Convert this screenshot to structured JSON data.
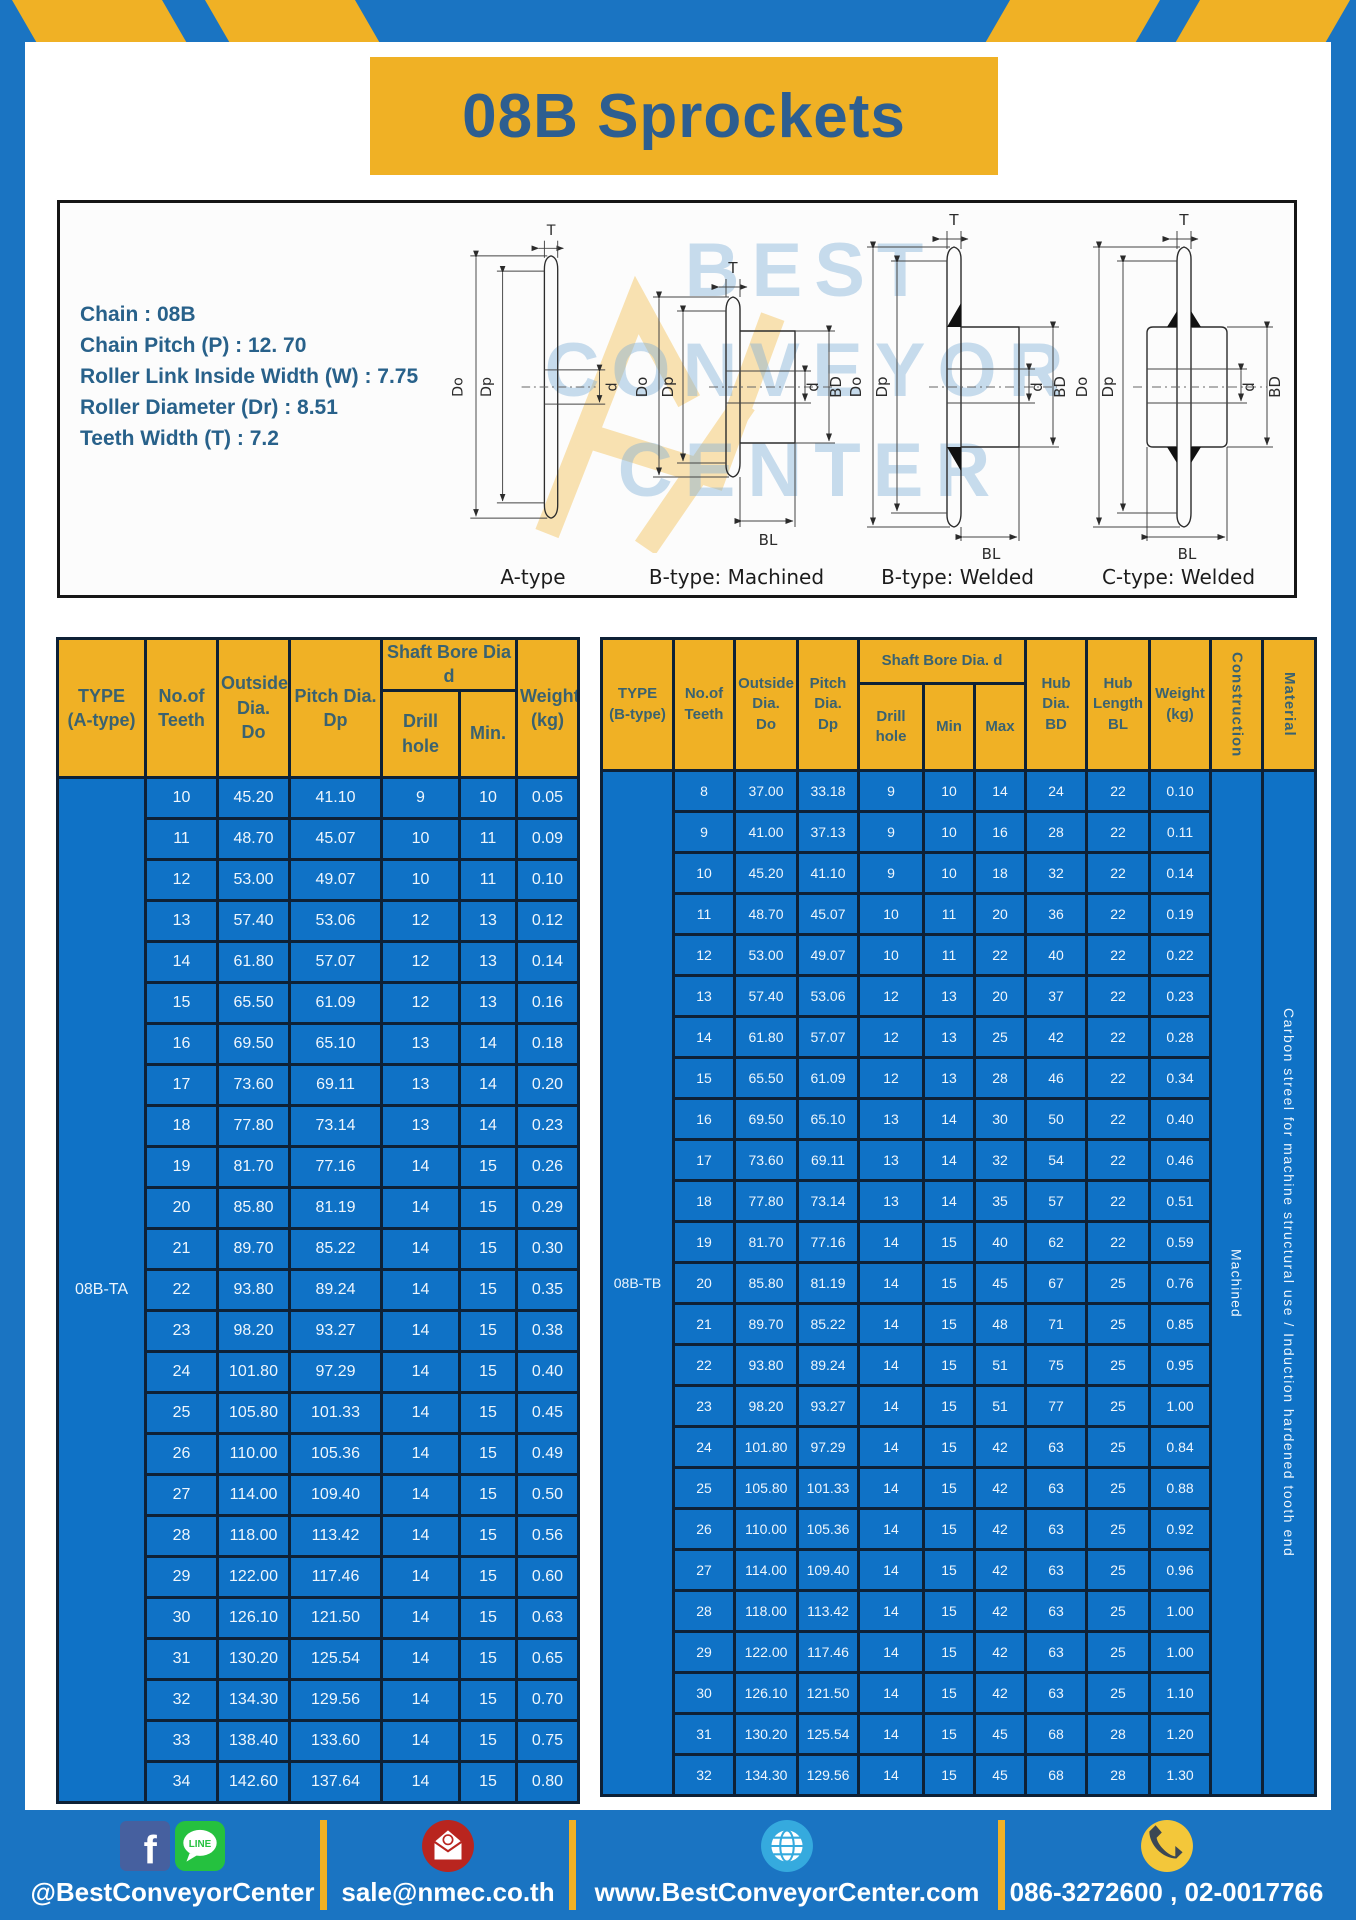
{
  "title": "08B Sprockets",
  "specs": [
    "Chain : 08B",
    "Chain Pitch (P) : 12. 70",
    "Roller Link Inside Width (W) : 7.75",
    "Roller Diameter (Dr) : 8.51",
    "Teeth Width (T) : 7.2"
  ],
  "diagram": {
    "watermark": "BEST\nCONVEYOR\nCENTER",
    "types": [
      "A-type",
      "B-type: Machined",
      "B-type: Welded",
      "C-type: Welded"
    ],
    "dims": {
      "T": "T",
      "Do": "Do",
      "Dp": "Dp",
      "d": "d",
      "BD": "BD",
      "BL": "BL"
    }
  },
  "table_a": {
    "headers": {
      "type": "TYPE\n(A-type)",
      "teeth": "No.of\nTeeth",
      "outside": "Outside\nDia.\nDo",
      "pitch": "Pitch Dia.\nDp",
      "shaft": "Shaft Bore Dia d",
      "drill": "Drill hole",
      "min": "Min.",
      "weight": "Weight\n(kg)"
    },
    "type_label": "08B-TA",
    "rows": [
      [
        "10",
        "45.20",
        "41.10",
        "9",
        "10",
        "0.05"
      ],
      [
        "11",
        "48.70",
        "45.07",
        "10",
        "11",
        "0.09"
      ],
      [
        "12",
        "53.00",
        "49.07",
        "10",
        "11",
        "0.10"
      ],
      [
        "13",
        "57.40",
        "53.06",
        "12",
        "13",
        "0.12"
      ],
      [
        "14",
        "61.80",
        "57.07",
        "12",
        "13",
        "0.14"
      ],
      [
        "15",
        "65.50",
        "61.09",
        "12",
        "13",
        "0.16"
      ],
      [
        "16",
        "69.50",
        "65.10",
        "13",
        "14",
        "0.18"
      ],
      [
        "17",
        "73.60",
        "69.11",
        "13",
        "14",
        "0.20"
      ],
      [
        "18",
        "77.80",
        "73.14",
        "13",
        "14",
        "0.23"
      ],
      [
        "19",
        "81.70",
        "77.16",
        "14",
        "15",
        "0.26"
      ],
      [
        "20",
        "85.80",
        "81.19",
        "14",
        "15",
        "0.29"
      ],
      [
        "21",
        "89.70",
        "85.22",
        "14",
        "15",
        "0.30"
      ],
      [
        "22",
        "93.80",
        "89.24",
        "14",
        "15",
        "0.35"
      ],
      [
        "23",
        "98.20",
        "93.27",
        "14",
        "15",
        "0.38"
      ],
      [
        "24",
        "101.80",
        "97.29",
        "14",
        "15",
        "0.40"
      ],
      [
        "25",
        "105.80",
        "101.33",
        "14",
        "15",
        "0.45"
      ],
      [
        "26",
        "110.00",
        "105.36",
        "14",
        "15",
        "0.49"
      ],
      [
        "27",
        "114.00",
        "109.40",
        "14",
        "15",
        "0.50"
      ],
      [
        "28",
        "118.00",
        "113.42",
        "14",
        "15",
        "0.56"
      ],
      [
        "29",
        "122.00",
        "117.46",
        "14",
        "15",
        "0.60"
      ],
      [
        "30",
        "126.10",
        "121.50",
        "14",
        "15",
        "0.63"
      ],
      [
        "31",
        "130.20",
        "125.54",
        "14",
        "15",
        "0.65"
      ],
      [
        "32",
        "134.30",
        "129.56",
        "14",
        "15",
        "0.70"
      ],
      [
        "33",
        "138.40",
        "133.60",
        "14",
        "15",
        "0.75"
      ],
      [
        "34",
        "142.60",
        "137.64",
        "14",
        "15",
        "0.80"
      ]
    ]
  },
  "table_b": {
    "headers": {
      "type": "TYPE\n(B-type)",
      "teeth": "No.of\nTeeth",
      "outside": "Outside\nDia.\nDo",
      "pitch": "Pitch\nDia.\nDp",
      "shaft": "Shaft Bore Dia. d",
      "drill": "Drill hole",
      "min": "Min",
      "max": "Max",
      "hub_dia": "Hub\nDia.\nBD",
      "hub_len": "Hub\nLength\nBL",
      "weight": "Weight\n(kg)",
      "construction": "Construction",
      "material": "Material"
    },
    "type_label": "08B-TB",
    "construction": "Machined",
    "material": "Carbon streel for machine structural use / Induction hardened tooth end",
    "rows": [
      [
        "8",
        "37.00",
        "33.18",
        "9",
        "10",
        "14",
        "24",
        "22",
        "0.10"
      ],
      [
        "9",
        "41.00",
        "37.13",
        "9",
        "10",
        "16",
        "28",
        "22",
        "0.11"
      ],
      [
        "10",
        "45.20",
        "41.10",
        "9",
        "10",
        "18",
        "32",
        "22",
        "0.14"
      ],
      [
        "11",
        "48.70",
        "45.07",
        "10",
        "11",
        "20",
        "36",
        "22",
        "0.19"
      ],
      [
        "12",
        "53.00",
        "49.07",
        "10",
        "11",
        "22",
        "40",
        "22",
        "0.22"
      ],
      [
        "13",
        "57.40",
        "53.06",
        "12",
        "13",
        "20",
        "37",
        "22",
        "0.23"
      ],
      [
        "14",
        "61.80",
        "57.07",
        "12",
        "13",
        "25",
        "42",
        "22",
        "0.28"
      ],
      [
        "15",
        "65.50",
        "61.09",
        "12",
        "13",
        "28",
        "46",
        "22",
        "0.34"
      ],
      [
        "16",
        "69.50",
        "65.10",
        "13",
        "14",
        "30",
        "50",
        "22",
        "0.40"
      ],
      [
        "17",
        "73.60",
        "69.11",
        "13",
        "14",
        "32",
        "54",
        "22",
        "0.46"
      ],
      [
        "18",
        "77.80",
        "73.14",
        "13",
        "14",
        "35",
        "57",
        "22",
        "0.51"
      ],
      [
        "19",
        "81.70",
        "77.16",
        "14",
        "15",
        "40",
        "62",
        "22",
        "0.59"
      ],
      [
        "20",
        "85.80",
        "81.19",
        "14",
        "15",
        "45",
        "67",
        "25",
        "0.76"
      ],
      [
        "21",
        "89.70",
        "85.22",
        "14",
        "15",
        "48",
        "71",
        "25",
        "0.85"
      ],
      [
        "22",
        "93.80",
        "89.24",
        "14",
        "15",
        "51",
        "75",
        "25",
        "0.95"
      ],
      [
        "23",
        "98.20",
        "93.27",
        "14",
        "15",
        "51",
        "77",
        "25",
        "1.00"
      ],
      [
        "24",
        "101.80",
        "97.29",
        "14",
        "15",
        "42",
        "63",
        "25",
        "0.84"
      ],
      [
        "25",
        "105.80",
        "101.33",
        "14",
        "15",
        "42",
        "63",
        "25",
        "0.88"
      ],
      [
        "26",
        "110.00",
        "105.36",
        "14",
        "15",
        "42",
        "63",
        "25",
        "0.92"
      ],
      [
        "27",
        "114.00",
        "109.40",
        "14",
        "15",
        "42",
        "63",
        "25",
        "0.96"
      ],
      [
        "28",
        "118.00",
        "113.42",
        "14",
        "15",
        "42",
        "63",
        "25",
        "1.00"
      ],
      [
        "29",
        "122.00",
        "117.46",
        "14",
        "15",
        "42",
        "63",
        "25",
        "1.00"
      ],
      [
        "30",
        "126.10",
        "121.50",
        "14",
        "15",
        "42",
        "63",
        "25",
        "1.10"
      ],
      [
        "31",
        "130.20",
        "125.54",
        "14",
        "15",
        "45",
        "68",
        "28",
        "1.20"
      ],
      [
        "32",
        "134.30",
        "129.56",
        "14",
        "15",
        "45",
        "68",
        "28",
        "1.30"
      ]
    ]
  },
  "footer": {
    "social": "@BestConveyorCenter",
    "email": "sale@nmec.co.th",
    "website": "www.BestConveyorCenter.com",
    "phone": "086-3272600 , 02-0017766",
    "facebook_f": "f",
    "line_label": "LINE"
  },
  "colors": {
    "frame_blue": "#1a74c2",
    "accent_yellow": "#f0b125",
    "table_cell_blue": "#0f72c6",
    "table_grid": "#0e2136",
    "header_text": "#3a6270",
    "title_text": "#2d5e90"
  }
}
